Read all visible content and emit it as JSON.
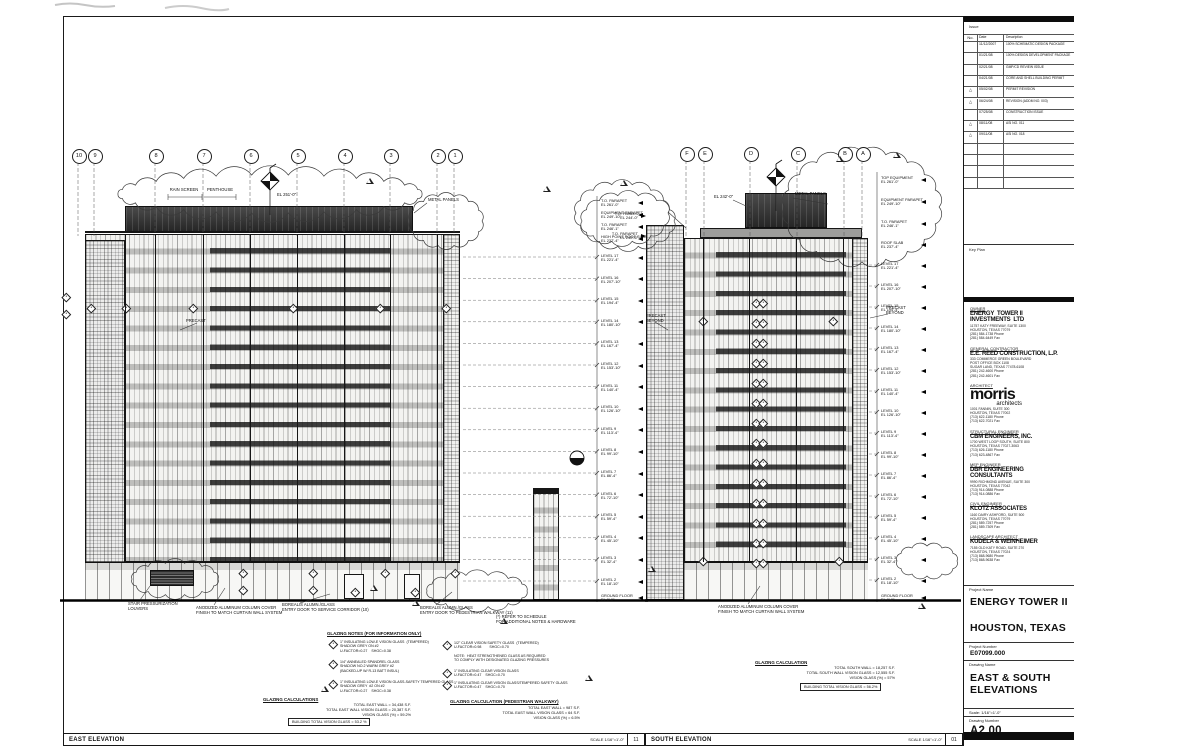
{
  "sheet": {
    "issue_label": "Issue",
    "revision_block": {
      "columns": [
        "No.",
        "Date",
        "Description"
      ],
      "rows": [
        {
          "no": "",
          "date": "11/12/2007",
          "desc": "100% SCHEMATIC DESIGN PACKAGE",
          "delta": false
        },
        {
          "no": "",
          "date": "01/21/08",
          "desc": "100% DESIGN DEVELOPMENT PACKAGE",
          "delta": false
        },
        {
          "no": "",
          "date": "02/21/08",
          "desc": "GMP/CD REVIEW ISSUE",
          "delta": false
        },
        {
          "no": "",
          "date": "04/21/08",
          "desc": "CORE AND SHELL BUILDING PERMIT",
          "delta": false
        },
        {
          "no": "2",
          "date": "05/02/08",
          "desc": "PERMIT REVISION",
          "delta": true
        },
        {
          "no": "3",
          "date": "06/24/08",
          "desc": "REVISION (ADDM NO. 003)",
          "delta": true
        },
        {
          "no": "",
          "date": "07/25/08",
          "desc": "CONSTRUCTION ISSUE",
          "delta": false
        },
        {
          "no": "4",
          "date": "08/11/08",
          "desc": "ASI NO. 011",
          "delta": true
        },
        {
          "no": "5",
          "date": "09/11/08",
          "desc": "ASI NO. 018",
          "delta": true
        }
      ],
      "empty_rows": 4
    },
    "key_plan_label": "Key Plan",
    "team": [
      {
        "role": "OWNER",
        "name": "ENERGY  TOWER II\nINVESTMENTS  LTD",
        "lines": [
          "11757 KATY FREEWAY, SUITE 1300",
          "HOUSTON, TEXAS 77079",
          "(281) 584-1738 Phone",
          "(281) 584-6449 Fax"
        ]
      },
      {
        "role": "GENERAL CONTRACTOR",
        "name": "E.E. REED CONSTRUCTION, L.P.",
        "lines": [
          "333 COMMERCE GREEN BOULEVARD",
          "POST OFFICE BOX 1108",
          "SUGAR LAND, TEXAS 77478-6108",
          "(281) 242-4600 Phone",
          "(281) 242-4601 Fax"
        ]
      },
      {
        "role": "ARCHITECT",
        "name": "morris",
        "sub": "architects",
        "lines": [
          "1001 FANNIN, SUITE 300",
          "HOUSTON, TEXAS 77002",
          "(713) 622-1180 Phone",
          "(713) 622-7021 Fax"
        ]
      },
      {
        "role": "STRUCTURAL ENGINEER",
        "name": "CBM ENGINEERS, INC.",
        "lines": [
          "1700 WEST LOOP SOUTH, SUITE 800",
          "HOUSTON, TEXAS 77027-3063",
          "(713) 626-1180 Phone",
          "(713) 623-4867 Fax"
        ]
      },
      {
        "role": "MEP ENGINEER",
        "name": "DBR ENGINEERING\nCONSULTANTS",
        "lines": [
          "9990 RICHMOND AVENUE, SUITE 300",
          "HOUSTON, TEXAS 77042",
          "(713) 914-0888 Phone",
          "(713) 914-0886 Fax"
        ]
      },
      {
        "role": "CIVIL ENGINEER",
        "name": "KLOTZ ASSOCIATES",
        "lines": [
          "1160 DAIRY ASHFORD, SUITE 500",
          "HOUSTON, TEXAS 77079",
          "(281) 589-7257 Phone",
          "(281) 589-7309 Fax"
        ]
      },
      {
        "role": "LANDSCAPE ARCHITECT",
        "name": "KUDELA & WEINHEIMER",
        "lines": [
          "7155 OLD KATY ROAD, SUITE 270",
          "HOUSTON, TEXAS 77024",
          "(713) 868-9680 Phone",
          "(713) 868-9638 Fax"
        ]
      }
    ],
    "project_name_label": "Project  Name",
    "project_name": "ENERGY TOWER II",
    "project_city": "HOUSTON, TEXAS",
    "project_number_label": "Project Number",
    "project_number": "E07099.000",
    "drawing_name_label": "Drawing Name",
    "drawing_name_line1": "EAST & SOUTH",
    "drawing_name_line2": "ELEVATIONS",
    "scale_label": "Scale:",
    "scale_value": "1/16\"=1'-0\"",
    "drawing_number_label": "Drawing Number",
    "drawing_number": "A2.00"
  },
  "east": {
    "title": "EAST ELEVATION",
    "scale": "SCALE  1/16\"=1'-0\"",
    "detail_no": "11",
    "grid_bubbles": [
      "10",
      "9",
      "8",
      "7",
      "6",
      "5",
      "4",
      "3",
      "2",
      "1"
    ],
    "top_specials": [
      {
        "name": "T.O. PARAPET",
        "el": "EL 261'-0\""
      },
      {
        "name": "EQUIPMENT PARAPET",
        "el": "EL 249'-10\""
      },
      {
        "name": "T.O. PARAPET",
        "el": "EL 246'-1\""
      },
      {
        "name": "HIGH POINT ROOF SLAB",
        "el": "EL 237'-4\""
      }
    ],
    "top_tags": {
      "rain_screen": "RAIN SCREEN",
      "penthouse": "PENTHOUSE",
      "el_tag": "EL 251'-0\"",
      "metal_panels": "METAL PANELS"
    },
    "precast_tag": "PRECAST",
    "ground_notes": [
      "STAIR PRESSURIZATION\nLOUVERS",
      "ANODIZED ALUMINUM COLUMN COVER\nFINISH TO MATCH CURTAIN WALL SYSTEM",
      "BOREALIS ALUMN./GLASS\nENTRY DOOR TO SERVICE CORRIDOR (10)",
      "BOREALIS ALUMN./GLASS\nENTRY DOOR TO PEDESTRIAN WALKWAY (11)",
      "(*) REFER TO SCHEDULE\nFOR ADDITIONAL NOTES & HARDWARE"
    ]
  },
  "south": {
    "title": "SOUTH ELEVATION",
    "scale": "SCALE  1/16\"=1'-0\"",
    "detail_no": "01",
    "grid_bubbles": [
      "F",
      "E",
      "D",
      "C",
      "B",
      "A"
    ],
    "top_specials": [
      {
        "name": "TOP EQUIPMENT",
        "el": "EL 261'-0\""
      },
      {
        "name": "EQUIPMENT PARAPET",
        "el": "EL 249'-10\""
      },
      {
        "name": "T.O. PARAPET",
        "el": "EL 246'-1\""
      },
      {
        "name": "ROOF SLAB",
        "el": "EL 237'-4\""
      }
    ],
    "left_specials": [
      {
        "name": "T.O. PANELS",
        "el": "EL 244'-0\""
      },
      {
        "name": "T.O. PARAPET",
        "el": "EL 240'-6\""
      }
    ],
    "top_tags": {
      "metal_panels": "METAL PANELS",
      "el_tag": "EL 242'-0\""
    },
    "precast_tag_left": "PRECAST\nBEYOND",
    "precast_tag_right": "PRECAST\nBEYOND",
    "ground_notes": [
      "ANODIZED ALUMINUM COLUMN COVER\nFINISH TO MATCH CURTAIN WALL SYSTEM"
    ]
  },
  "levels": [
    {
      "name": "LEVEL 17",
      "el": "EL 221'-4\""
    },
    {
      "name": "LEVEL 16",
      "el": "EL 207'-10\""
    },
    {
      "name": "LEVEL 15",
      "el": "EL 194'-4\""
    },
    {
      "name": "LEVEL 14",
      "el": "EL 180'-10\""
    },
    {
      "name": "LEVEL 13",
      "el": "EL 167'-4\""
    },
    {
      "name": "LEVEL 12",
      "el": "EL 153'-10\""
    },
    {
      "name": "LEVEL 11",
      "el": "EL 140'-4\""
    },
    {
      "name": "LEVEL 10",
      "el": "EL 126'-10\""
    },
    {
      "name": "LEVEL 9",
      "el": "EL 113'-4\""
    },
    {
      "name": "LEVEL 8",
      "el": "EL 99'-10\""
    },
    {
      "name": "LEVEL 7",
      "el": "EL 86'-4\""
    },
    {
      "name": "LEVEL 6",
      "el": "EL 72'-10\""
    },
    {
      "name": "LEVEL 5",
      "el": "EL 59'-4\""
    },
    {
      "name": "LEVEL 4",
      "el": "EL 45'-10\""
    },
    {
      "name": "LEVEL 3",
      "el": "EL 32'-4\""
    },
    {
      "name": "LEVEL 2",
      "el": "EL 18'-10\""
    }
  ],
  "ground_level": {
    "name": "GROUND FLOOR",
    "el": "EL 0'-0\""
  },
  "glazing": {
    "legend_header": "GLAZING NOTES (FOR INFORMATION ONLY)",
    "left_items": [
      "1\" INSULATING LOW-E VISION GLASS  (TEMPERED)\nSHADOW GREY ON #2\nU-FACTOR=0.27    SHGC=0.38",
      "1/4\" ANNEALED SPANDREL GLASS\nSHADOW NO.2 WARM GREY #2\n(BACKED-UP W/ R-13 BATT INSUL)",
      "1\" INSULATING LOW-E VISION GLASS-SAFETY TEMPERED GLASS\nSHADOW GREY  #2 ON #2\nU-FACTOR=0.27    SHGC=0.38"
    ],
    "mid_items": [
      "1/2\" CLEAR VISION SAFETY GLASS  (TEMPERED)\nU-FACTOR=0.98        SHGC=0.70",
      "NOTE:  HEAT STRENGTHENED GLASS AS REQUIRED\nTO COMPLY WITH DESIGNATED GLAZING PRESSURES",
      "1\" INSULATING CLEAR VISION GLASS\nU-FACTOR=0.47    SHGC=0.70",
      "1\" INSULATING CLEAR VISION GLASS/TEMPERED SAFETY GLASS\nU-FACTOR=0.47    SHGC=0.70"
    ],
    "calc_east_header": "GLAZING CALCULATIONS",
    "calc_east": "TOTAL EAST WALL = 34,438 S.F.\nTOTAL EAST WALL VISION GLASS = 20,387 S.F.\nVISION GLASS (%) = 59.2%",
    "calc_east_total": "BUILDING TOTAL VISION GLASS = 53.2 %",
    "calc_walkway_header": "GLAZING CALCULATION (PEDESTRIAN WALKWAY)",
    "calc_walkway": "TOTAL EAST WALL = 987 S.F.\nTOTAL EAST WALL VISION GLASS = 64 S.F.\nVISION GLASS (%) = 6.5%",
    "calc_south_header": "GLAZING CALCULATION",
    "calc_south": "TOTAL SOUTH WALL = 18,257 S.F.\nTOTAL SOUTH WALL VISION GLASS = 12,555 S.F.\nVISION GLASS (%) = 57%",
    "calc_south_total": "BUILDING TOTAL VISION GLASS = 56.2%"
  }
}
